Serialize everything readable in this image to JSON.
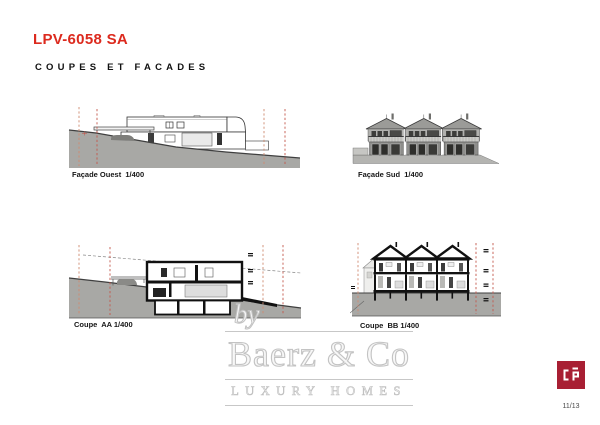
{
  "header": {
    "title": "LPV-6058 SA",
    "subtitle": "COUPES ET FACADES"
  },
  "drawings": [
    {
      "id": "facade-ouest",
      "label": "Façade Ouest  1/400",
      "scale": "1/400"
    },
    {
      "id": "facade-sud",
      "label": "Façade Sud  1/400",
      "scale": "1/400"
    },
    {
      "id": "coupe-aa",
      "label": "Coupe  AA 1/400",
      "scale": "1/400"
    },
    {
      "id": "coupe-bb",
      "label": "Coupe  BB 1/400",
      "scale": "1/400"
    }
  ],
  "watermark": {
    "by": "by",
    "brand": "Baerz & Co",
    "tagline": "LUXURY HOMES"
  },
  "footer": {
    "page_number": "11/13"
  },
  "logo": {
    "name": "cp-architecture-logo",
    "background": "#a81f33"
  },
  "colors": {
    "accent_red": "#dc2a1e",
    "terrain_gray": "#a8a8a5",
    "boundary_dash_light": "#cf8a70",
    "boundary_dash_dark": "#c3584d",
    "watermark_gray": "#c7c7c7"
  }
}
